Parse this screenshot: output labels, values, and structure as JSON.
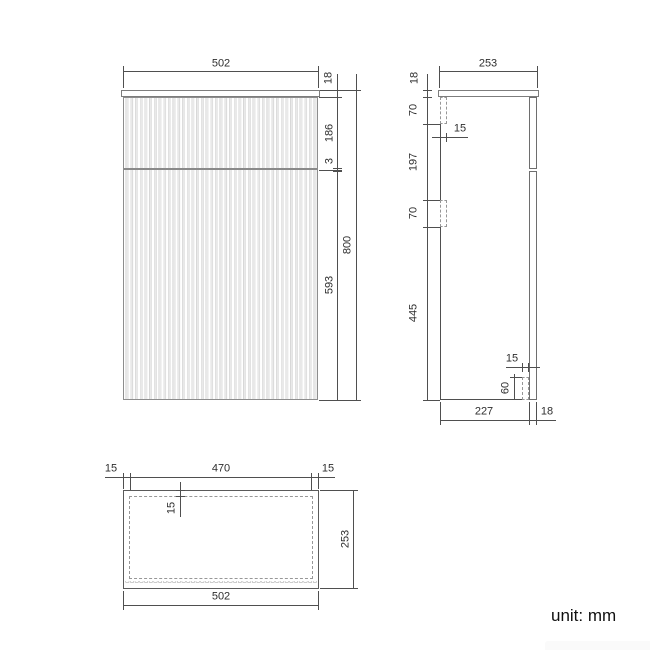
{
  "front_view": {
    "overall_width": "502",
    "top_panel": "18",
    "upper_front": "186",
    "gap": "3",
    "lower_front": "593",
    "overall_height": "800"
  },
  "side_view": {
    "overall_depth": "253",
    "top_panel": "18",
    "hinge_top_offset": "70",
    "hinge_depth": "15",
    "hinge_spacing": "197",
    "hinge_bottom": "70",
    "bottom_section": "445",
    "bracket_depth": "15",
    "bracket_height": "60",
    "carcass_depth": "227",
    "front_panel": "18"
  },
  "plan_view": {
    "left_inset": "15",
    "inner_width": "470",
    "right_inset": "15",
    "panel_thickness": "15",
    "overall_depth": "253",
    "overall_width": "502"
  },
  "footer": {
    "unit_note": "unit: mm"
  }
}
